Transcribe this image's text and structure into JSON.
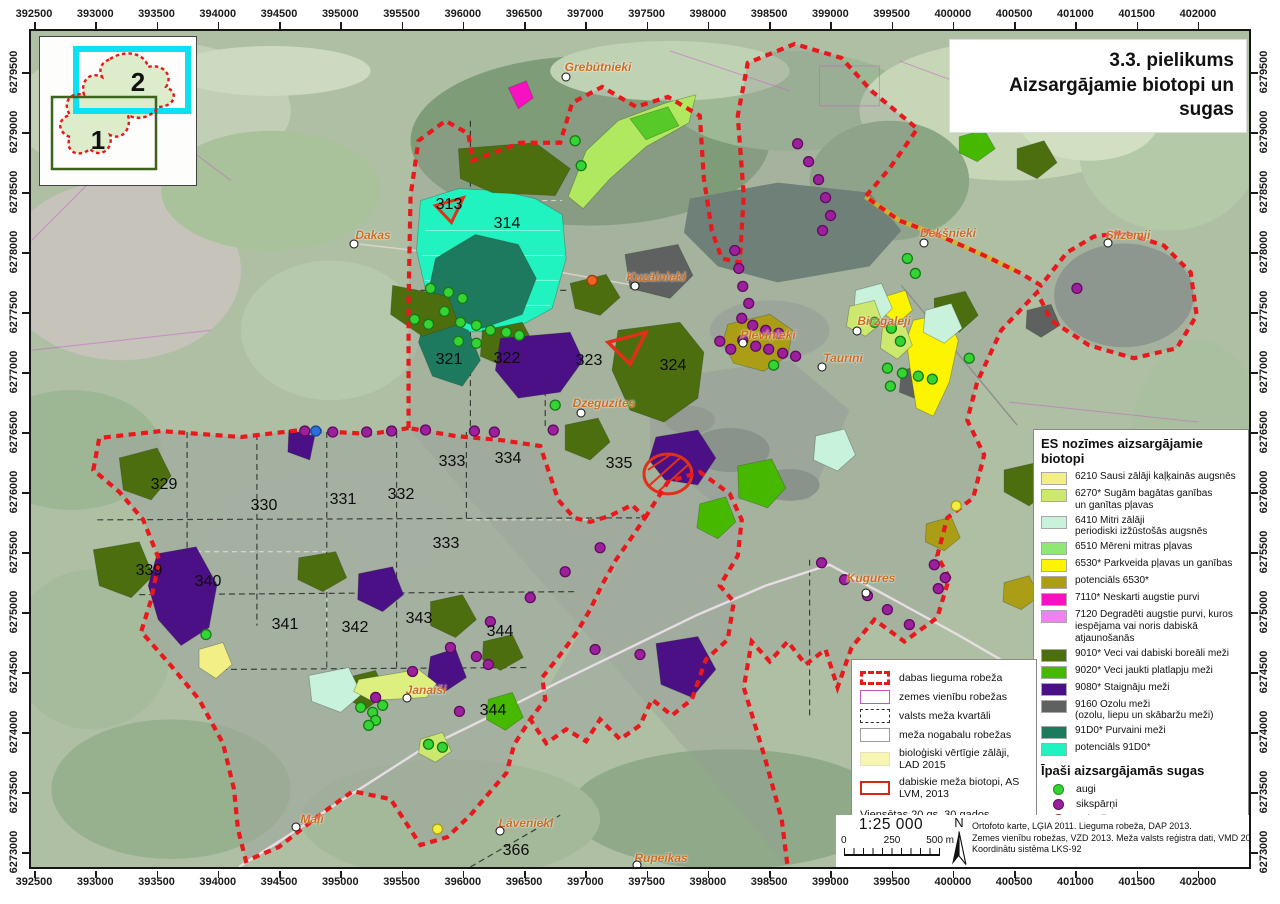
{
  "title": {
    "line1": "3.3. pielikums",
    "line2": "Aizsargājamie biotopi un sugas"
  },
  "grid": {
    "top": [
      "392500",
      "393000",
      "393500",
      "394000",
      "394500",
      "395000",
      "395500",
      "396000",
      "396500",
      "397000",
      "397500",
      "398000",
      "398500",
      "399000",
      "399500",
      "400000",
      "400500",
      "401000",
      "401500",
      "402000"
    ],
    "left": [
      "6279500",
      "6279000",
      "6278500",
      "6278000",
      "6277500",
      "6277000",
      "6276500",
      "6276000",
      "6275500",
      "6275000",
      "6274500",
      "6274000",
      "6273500",
      "6273000"
    ]
  },
  "inset": {
    "region1": "1",
    "region2": "2"
  },
  "biotope_legend": {
    "header": "ES nozīmes aizsargājamie biotopi",
    "items": [
      {
        "color": "#f1ef85",
        "label": "6210 Sausi zālāji kaļķainās augsnēs"
      },
      {
        "color": "#cde86e",
        "label": "6270* Sugām bagātas ganības\nun ganītas pļavas"
      },
      {
        "color": "#c9f2dd",
        "label": "6410 Mitri zālāji\nperiodiski izžūstošās augsnēs"
      },
      {
        "color": "#8fe873",
        "label": "6510 Mēreni mitras pļavas"
      },
      {
        "color": "#fdf402",
        "label": "6530* Parkveida pļavas un ganības"
      },
      {
        "color": "#ab9e16",
        "label": "potenciāls 6530*"
      },
      {
        "color": "#f711c0",
        "label": "7110* Neskarti augstie purvi"
      },
      {
        "color": "#ee82ee",
        "label": "7120 Degradēti augstie purvi, kuros\niespējama vai noris dabiskā atjaunošanās"
      },
      {
        "color": "#4c6e0f",
        "label": "9010* Veci vai dabiski boreāli meži"
      },
      {
        "color": "#46b800",
        "label": "9020* Veci jaukti platlapju meži"
      },
      {
        "color": "#4b0f86",
        "label": "9080* Staignāju meži"
      },
      {
        "color": "#5f6160",
        "label": "9160 Ozolu meži\n(ozolu, liepu un skābaržu meži)"
      },
      {
        "color": "#1d7a5f",
        "label": "91D0* Purvaini meži"
      },
      {
        "color": "#20f2c0",
        "label": "potenciāls 91D0*"
      }
    ]
  },
  "species_legend": {
    "header": "Īpaši aizsargājamās sugas",
    "items": [
      {
        "color": "#35d435",
        "ring": "#1c8a1c",
        "label": "augi"
      },
      {
        "color": "#9c1f9c",
        "ring": "#5e0d5e",
        "label": "sikspārņi"
      },
      {
        "color": "#ed6420",
        "ring": "#9e3c0c",
        "label": "zīdītāji"
      },
      {
        "color": "#2a6fdb",
        "ring": "#134a9e",
        "label": "abinieki"
      },
      {
        "color": "#f2ee3f",
        "ring": "#a89e16",
        "label": "bezmugurkaulnieki"
      }
    ]
  },
  "boundary_legend": {
    "items": [
      {
        "type": "red-dashed",
        "label": "dabas lieguma robeža"
      },
      {
        "type": "magenta-box",
        "label": "zemes vienību robežas"
      },
      {
        "type": "black-dashed",
        "label": "valsts meža kvartāli"
      },
      {
        "type": "white-box",
        "label": "meža nogabalu robežas"
      },
      {
        "type": "yellow-fill",
        "label": "bioloģiski vērtīgie zālāji, LAD 2015"
      },
      {
        "type": "red-outline",
        "label": "dabiskie meža biotopi, AS LVM, 2013"
      }
    ],
    "homesteads_label": "Viensētas 20.gs. 30.gados",
    "homestead_example": "Birznieki"
  },
  "scalebar": {
    "ratio": "1:25 000",
    "zero": "0",
    "mid": "250",
    "end": "500 m"
  },
  "north": "N",
  "credits": {
    "line1": "Ortofoto karte, LĢIA 2011. Lieguma robeža, DAP 2013.",
    "line2": "Zemes vienību robežas, VZD 2013. Meža valsts reģistra dati, VMD 2013.",
    "line3": "Koordinātu sistēma LKS-92"
  },
  "map": {
    "quarter_numbers": [
      {
        "n": "313",
        "x": 418,
        "y": 174
      },
      {
        "n": "314",
        "x": 476,
        "y": 193
      },
      {
        "n": "321",
        "x": 418,
        "y": 329
      },
      {
        "n": "322",
        "x": 476,
        "y": 328
      },
      {
        "n": "323",
        "x": 558,
        "y": 330
      },
      {
        "n": "324",
        "x": 642,
        "y": 335
      },
      {
        "n": "329",
        "x": 133,
        "y": 454
      },
      {
        "n": "330",
        "x": 233,
        "y": 475
      },
      {
        "n": "331",
        "x": 312,
        "y": 469
      },
      {
        "n": "332",
        "x": 370,
        "y": 464
      },
      {
        "n": "333",
        "x": 421,
        "y": 431
      },
      {
        "n": "334",
        "x": 477,
        "y": 428
      },
      {
        "n": "335",
        "x": 588,
        "y": 433
      },
      {
        "n": "333",
        "x": 415,
        "y": 513
      },
      {
        "n": "339",
        "x": 118,
        "y": 540
      },
      {
        "n": "340",
        "x": 177,
        "y": 551
      },
      {
        "n": "341",
        "x": 254,
        "y": 594
      },
      {
        "n": "342",
        "x": 324,
        "y": 597
      },
      {
        "n": "343",
        "x": 388,
        "y": 588
      },
      {
        "n": "344",
        "x": 469,
        "y": 601
      },
      {
        "n": "344",
        "x": 462,
        "y": 680
      },
      {
        "n": "366",
        "x": 485,
        "y": 820
      }
    ],
    "places": [
      {
        "name": "Grebūtnieki",
        "x": 567,
        "y": 36,
        "cx": 535,
        "cy": 46
      },
      {
        "name": "Dakas",
        "x": 342,
        "y": 204,
        "cx": 323,
        "cy": 213
      },
      {
        "name": "Kuzāinieki",
        "x": 625,
        "y": 246,
        "cx": 604,
        "cy": 255
      },
      {
        "name": "Dekšnieki",
        "x": 917,
        "y": 202,
        "cx": 893,
        "cy": 212
      },
      {
        "name": "Silzemji",
        "x": 1097,
        "y": 204,
        "cx": 1077,
        "cy": 212
      },
      {
        "name": "Pleviņieki",
        "x": 737,
        "y": 304,
        "cx": 712,
        "cy": 312
      },
      {
        "name": "Tauriņi",
        "x": 812,
        "y": 327,
        "cx": 791,
        "cy": 336
      },
      {
        "name": "Birzgaleji",
        "x": 853,
        "y": 290,
        "cx": 826,
        "cy": 300
      },
      {
        "name": "Dzeguzītes",
        "x": 573,
        "y": 372,
        "cx": 550,
        "cy": 382
      },
      {
        "name": "Kugures",
        "x": 840,
        "y": 547,
        "cx": 835,
        "cy": 562
      },
      {
        "name": "Janaiši",
        "x": 395,
        "y": 659,
        "cx": 376,
        "cy": 667
      },
      {
        "name": "Maļi",
        "x": 281,
        "y": 788,
        "cx": 265,
        "cy": 796
      },
      {
        "name": "Lāvenieki",
        "x": 495,
        "y": 792,
        "cx": 469,
        "cy": 800
      },
      {
        "name": "Rupeikas",
        "x": 630,
        "y": 827,
        "cx": 606,
        "cy": 834
      }
    ]
  }
}
